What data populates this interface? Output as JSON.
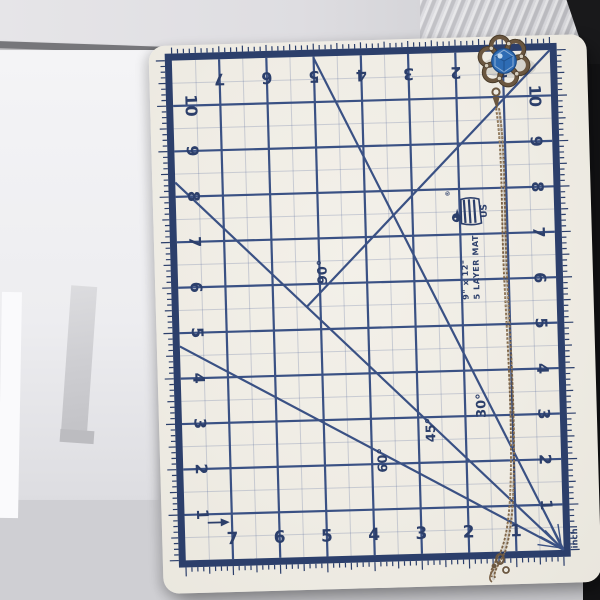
{
  "mat": {
    "brand": {
      "registered": "®",
      "flag_text": "US",
      "size": "9\" x 12\"",
      "layers": "5 LAYER MAT"
    },
    "unit_label": "inch",
    "numbers_top": [
      "7",
      "6",
      "5",
      "4",
      "3",
      "2",
      "1"
    ],
    "numbers_bottom": [
      "7",
      "6",
      "5",
      "4",
      "3",
      "2",
      "1"
    ],
    "numbers_left": [
      "10",
      "9",
      "8",
      "7",
      "6",
      "5",
      "4",
      "3",
      "2",
      "1"
    ],
    "numbers_right": [
      "10",
      "9",
      "8",
      "7",
      "6",
      "5",
      "4",
      "3",
      "2",
      "1"
    ],
    "angle_labels": [
      "90°",
      "45°",
      "30°",
      "60°"
    ],
    "colors": {
      "mat_cream": "#efece4",
      "ruler_navy": "#2c3f6b",
      "grid_line": "#3a5184"
    }
  },
  "necklace": {
    "pendant": "flower-filigree-pendant",
    "gem_color": "#2e6cb4",
    "metal_color": "#6b5740",
    "chain_color": "#7a6248"
  },
  "scene": {
    "background_color": "#cfcfd3",
    "shadow_color": "#141416"
  }
}
